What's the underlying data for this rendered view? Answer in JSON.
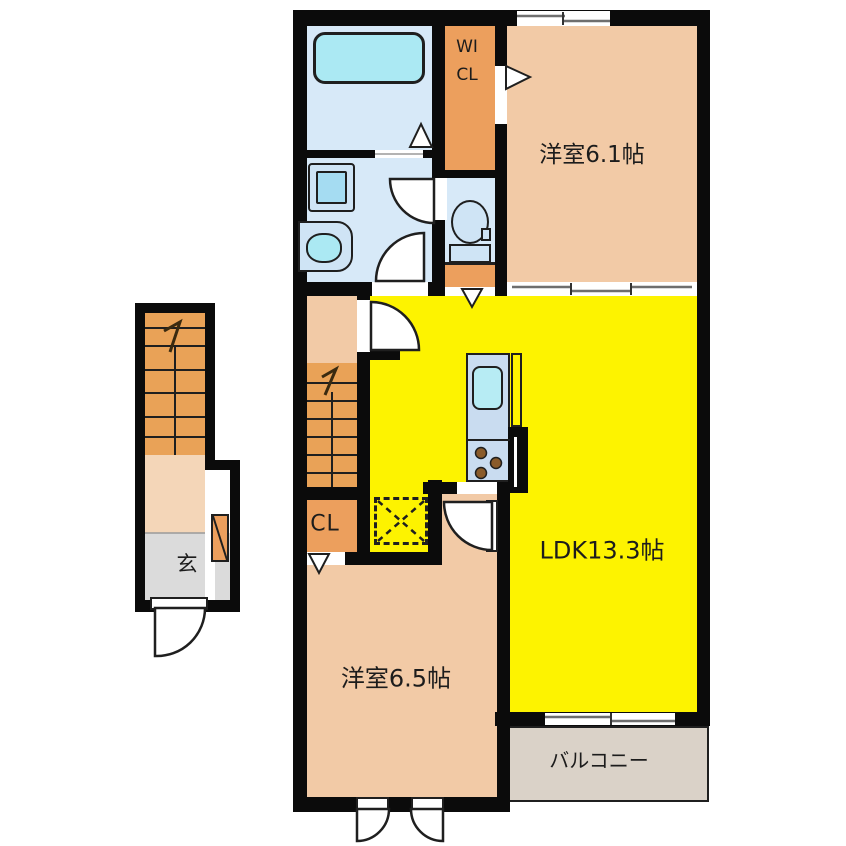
{
  "title": "2F apartment floor plan",
  "labels": {
    "bedroom1": "洋室6.1帖",
    "bedroom2": "洋室6.5帖",
    "ldk": "LDK13.3帖",
    "balcony": "バルコニー",
    "wicl": "WICL",
    "closet": "CL",
    "entrance": "玄"
  },
  "colors": {
    "wall": "#0b0b0b",
    "stroke": "#1f1f1f",
    "peach": "#F2CAA6",
    "orange": "#EC9F5D",
    "stair": "#E9A257",
    "landing": "#F4D6B8",
    "yellow": "#FDF300",
    "lblue": "#D7E9F8",
    "cyan": "#ABE9F3",
    "lblue2": "#CFE4F5",
    "cyan2": "#A5DCF2",
    "kblue": "#C9DCF0",
    "ksink": "#B7ECF4",
    "bal": "#DAD2C8",
    "gray": "#DBDBDB",
    "burner": "#8A5B2A"
  }
}
